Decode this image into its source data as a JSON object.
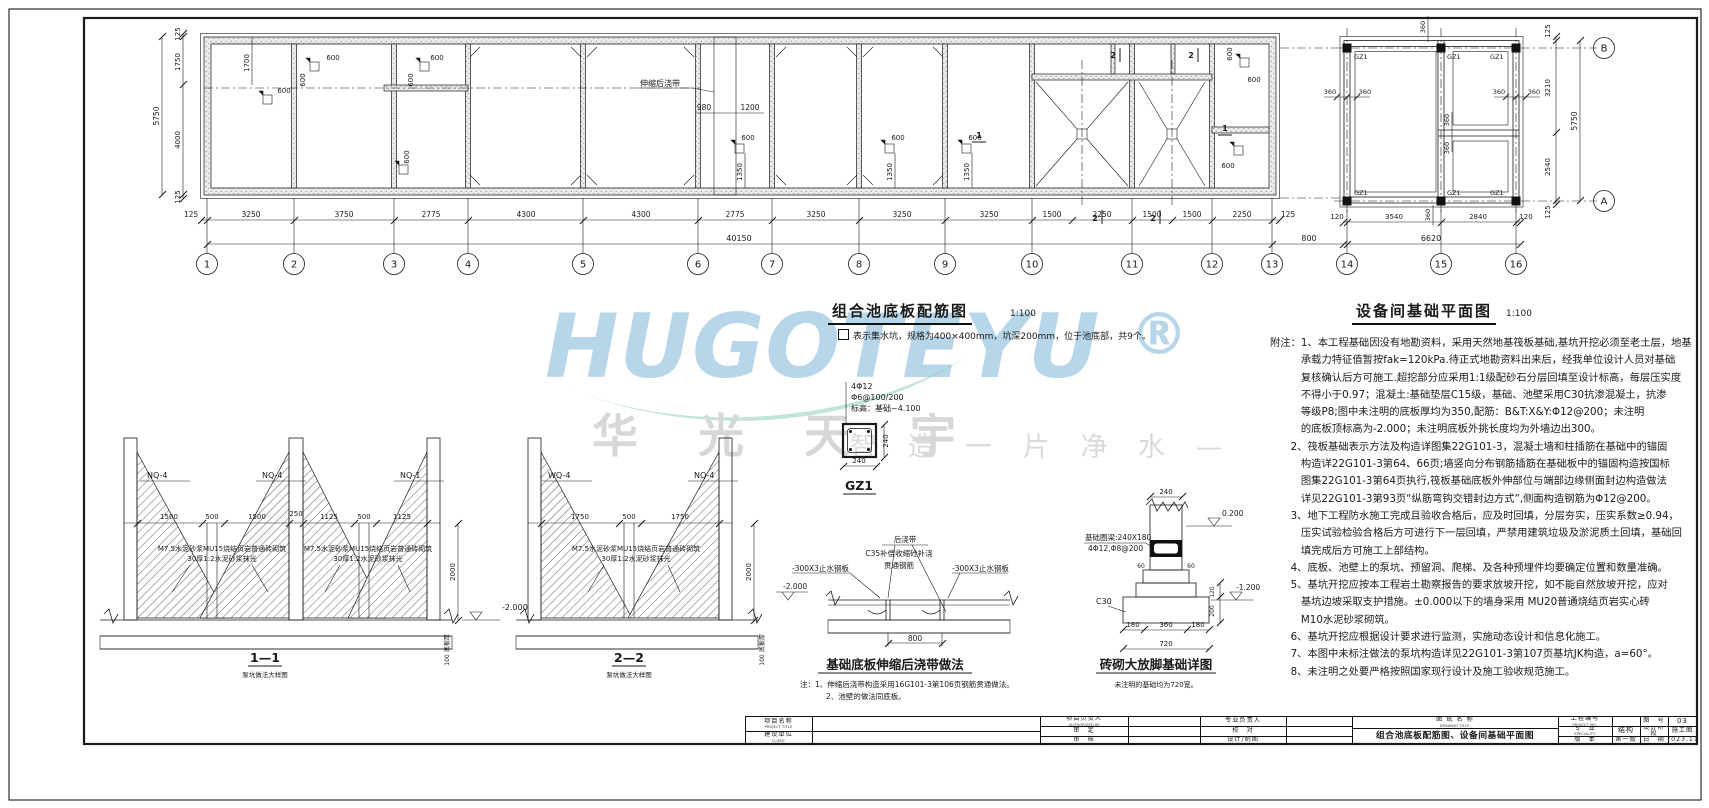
{
  "watermark": {
    "brand": "HUGOTEYU",
    "reg": "®",
    "cn": "华 光 天 宇",
    "slogan": "智 造 一 片 净 水 —",
    "brand_color": "#b7d6e9",
    "cn_color": "#d7d7d7",
    "swoosh_color": "#8fd0bd"
  },
  "plan_main": {
    "title": "组合池底板配筋图",
    "scale": "1:100",
    "legend": "表示集水坑，规格为400×400mm，坑深200mm，位于池底部，共9个。",
    "joint_label": "伸缩后浇带",
    "axes": [
      "1",
      "2",
      "3",
      "4",
      "5",
      "6",
      "7",
      "8",
      "9",
      "10",
      "11",
      "12",
      "13"
    ],
    "dims_bottom": [
      "125",
      "3250",
      "3750",
      "2775",
      "4300",
      "4300",
      "2775",
      "3250",
      "3250",
      "3250",
      "1500",
      "2250",
      "1500",
      "1500",
      "2250",
      "125"
    ],
    "dim_total": "40150",
    "dims_left": [
      "125",
      "1750",
      "4000",
      "125"
    ],
    "dim_left_total": "5750",
    "dim_gap": "800",
    "d600": "600",
    "d1350": "1350",
    "d1700": "1700",
    "d980": "980",
    "d1200": "1200",
    "mark1": "1",
    "mark2": "2"
  },
  "plan_equip": {
    "title": "设备间基础平面图",
    "scale": "1:100",
    "axes": [
      "14",
      "15",
      "16"
    ],
    "row_axes": [
      "B",
      "A"
    ],
    "dims_bottom": [
      "120",
      "3540",
      "2840",
      "120"
    ],
    "dim_total": "6620",
    "dims_right": [
      "125",
      "3210",
      "2540",
      "125"
    ],
    "dim_right_total": "5750",
    "d360": "360",
    "col": "GZ1"
  },
  "notes": {
    "lines": [
      "附注：1、本工程基础因没有地勘资料，采用天然地基筏板基础,基坑开挖必须至老土层，地基",
      "　　　承载力特征值暂按fak=120kPa.待正式地勘资料出来后，经我单位设计人员对基础",
      "　　　复核确认后方可施工.超挖部分应采用1:1级配砂石分层回填至设计标高，每层压实度",
      "　　　不得小于0.97；混凝土:基础垫层C15级，基础、池壁采用C30抗渗混凝土，抗渗",
      "　　　等级P8;图中未注明的底板厚均为350,配筋：B&T:X&Y:Φ12@200；未注明",
      "　　　的底板顶标高为-2.000；未注明底板外挑长度均为外墙边出300。",
      "　　2、筏板基础表示方法及构造详图集22G101-3，混凝土墙和柱插筋在基础中的锚固",
      "　　　构造详22G101-3第64、66页;墙竖向分布钢筋插筋在基础板中的锚固构造按国标",
      "　　　图集22G101-3第64页执行,筏板基础底板外伸部位与端部边缘侧面封边构造做法",
      "　　　详见22G101-3第93页“纵筋弯钩交错封边方式”,侧面构造钢筋为Φ12@200。",
      "　　3、地下工程防水施工完成且验收合格后，应及时回填，分层夯实，压实系数≥0.94，",
      "　　　压实试验检验合格后方可进行下一层回填，严禁用建筑垃圾及淤泥质土回填，基础回",
      "　　　填完成后方可施工上部结构。",
      "　　4、底板、池壁上的泵坑、预留洞、爬梯、及各种预埋件均要确定位置和数量准确。",
      "　　5、基坑开挖应按本工程岩土勘察报告的要求放坡开挖，如不能自然放坡开挖，应对",
      "　　　基坑边坡采取支护措施。±0.000以下的墙身采用 MU20普通烧结页岩实心砖",
      "　　　M10水泥砂浆砌筑。",
      "　　6、基坑开挖应根据设计要求进行监测，实施动态设计和信息化施工。",
      "　　7、本图中未标注做法的泵坑构造详见22G101-3第107页基坑JK构造，a=60°。",
      "　　8、未注明之处要严格按照国家现行设计及施工验收规范施工。"
    ]
  },
  "sections": {
    "s11": {
      "caption": "1—1",
      "dims": [
        "1500",
        "500",
        "1500",
        "250",
        "1125",
        "500",
        "1125"
      ],
      "walls": [
        "NQ-4",
        "NQ-4",
        "NQ-1"
      ]
    },
    "s22": {
      "caption": "2—2",
      "dims": [
        "1750",
        "500",
        "1750"
      ],
      "walls": [
        "WQ-4",
        "NQ-4"
      ]
    },
    "subcaption": "泵坑做法大样图",
    "ann1": "M7.5水泥砂浆MU15烧结页岩普通砖砌筑",
    "ann2": "30厚1:2水泥砂浆抹光",
    "dim2000": "2000",
    "level": "-2.000",
    "slab_label": "底板厚",
    "dim100": "100"
  },
  "gz1": {
    "bars": "4Φ12",
    "ties": "Φ6@100/200",
    "elev": "标高：基础~4.100",
    "d240": "240",
    "name": "GZ1"
  },
  "joint": {
    "l1": "后浇带",
    "l2": "C35补偿收缩砼补浇",
    "l3": "贯通钢筋",
    "plate": "-300X3止水钢板",
    "level": "-2.000",
    "d800": "800",
    "title": "基础底板伸缩后浇带做法",
    "note1": "注：1、伸缩后浇带构造采用16G101-3第106页钢筋贯通做法。",
    "note2": "2、池壁的做法同底板。"
  },
  "footing": {
    "beam1": "基础圈梁:240X180",
    "beam2": "4Φ12,Φ8@200",
    "c30": "C30",
    "lv_top": "0.200",
    "lv_bot": "-1.200",
    "d240": "240",
    "d60": "60",
    "dims": [
      "180",
      "360",
      "180"
    ],
    "d720": "720",
    "d120": "120",
    "d200": "200",
    "title": "砖砌大放脚基础详图",
    "note": "未注明的基础均为720宽。"
  },
  "titleblock": {
    "project_label": "项目名称",
    "project_en": "PROJECT TITLE",
    "client_label": "建设单位",
    "client_en": "CLIENT",
    "pm_label": "项目负责人",
    "pm_en": "AUTHORIZED BY",
    "approve_label": "审　定",
    "check_label": "审　核",
    "lead_label": "专业负责人",
    "proof_label": "校　对",
    "draw_label": "设计/制图",
    "dwg_label": "图 纸 名 称",
    "dwg_en": "DRAWING TITLE",
    "dwg_title": "组合池底板配筋图、设备间基础平面图",
    "projno_label": "工程编号",
    "projno_en": "PROJECT NO.",
    "spec_label": "专　业",
    "spec_en": "SPECIALITY",
    "spec_value": "结构",
    "ver_label": "版　本",
    "ver_value": "第一版",
    "figno_label": "图　号",
    "figno_value": "03",
    "stage_label": "设计阶段",
    "stage_en": "DESIGN STAGE",
    "stage_value": "施工图",
    "date_label": "日　期",
    "date_value": "2023.11"
  }
}
